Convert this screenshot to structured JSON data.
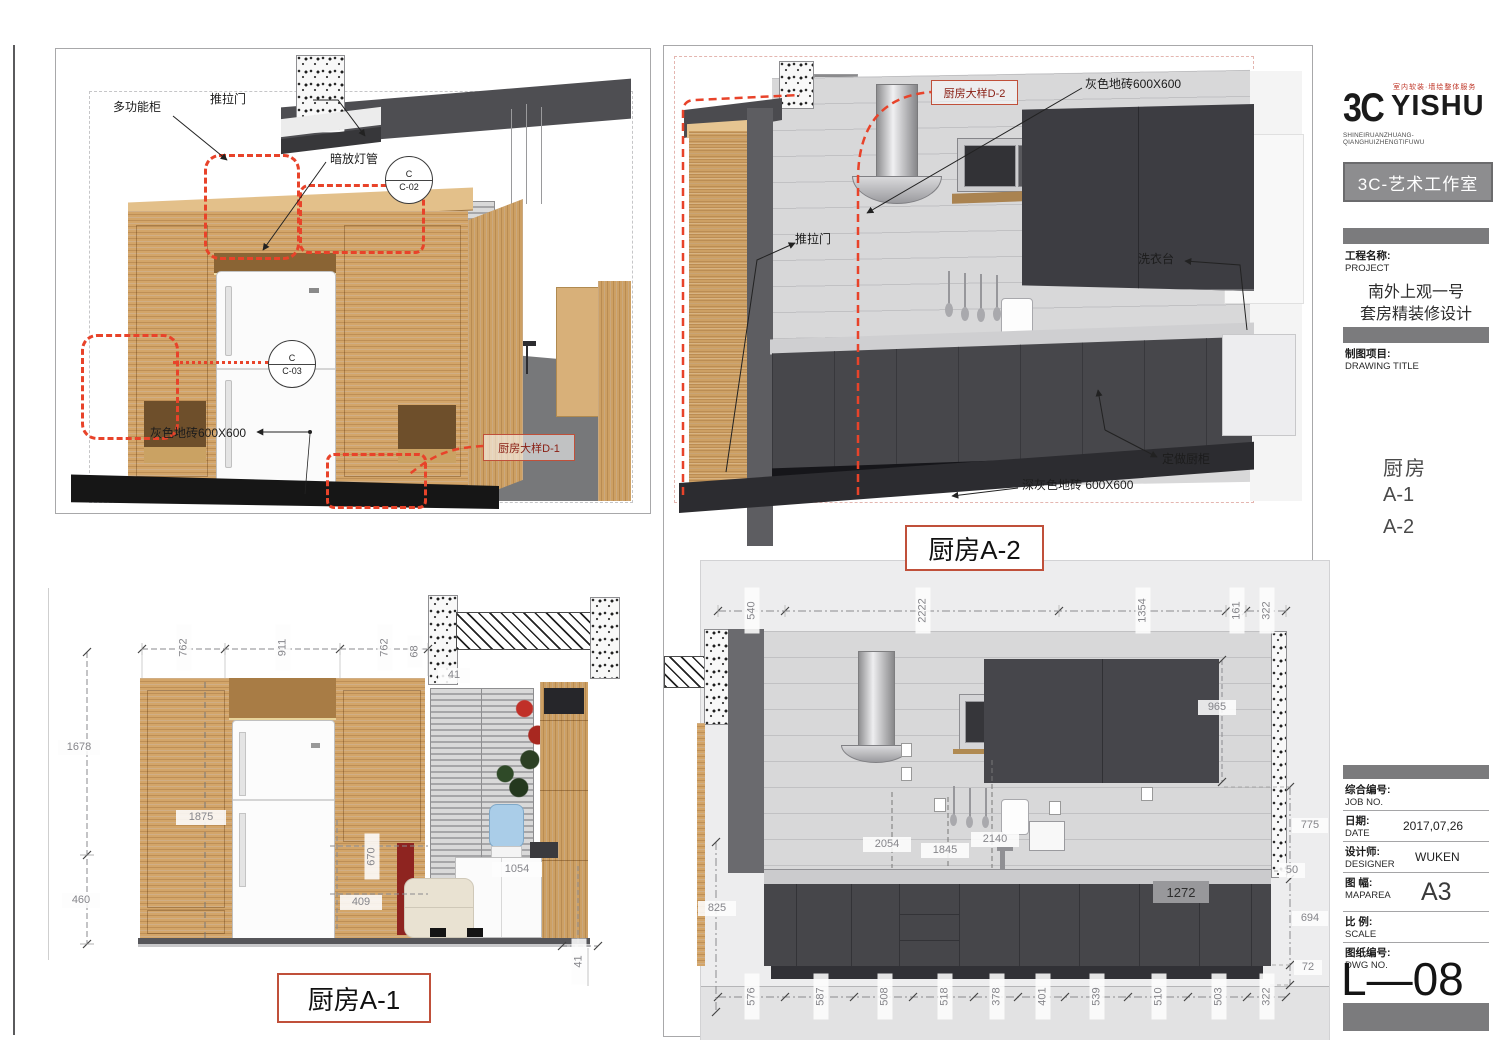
{
  "logo": {
    "mark": "3C",
    "name": "YISHU",
    "tagline_cn": "室内软装·墙绘整体服务",
    "tagline_en": "SHINEIRUANZHUANG-QIANGHUIZHENGTIFUWU",
    "studio_box": "3C-艺术工作室"
  },
  "titleblock": {
    "project": {
      "label_cn": "工程名称:",
      "label_en": "PROJECT",
      "line1": "南外上观一号",
      "line2": "套房精装修设计"
    },
    "drawing_title": {
      "label_cn": "制图项目:",
      "label_en": "DRAWING TITLE"
    },
    "drawing_name": {
      "line1": "厨房",
      "line2": "A-1",
      "line3": "A-2"
    },
    "job": {
      "label_cn": "综合编号:",
      "label_en": "JOB NO."
    },
    "date": {
      "label_cn": "日期:",
      "label_en": "DATE",
      "value": "2017,07,26"
    },
    "designer": {
      "label_cn": "设计师:",
      "label_en": "DESIGNER",
      "value": "WUKEN"
    },
    "map": {
      "label_cn": "图 幅:",
      "label_en": "MAPAREA",
      "value": "A3"
    },
    "scale": {
      "label_cn": "比 例:",
      "label_en": "SCALE"
    },
    "dwg": {
      "label_cn": "图纸编号:",
      "label_en": "DWG NO.",
      "value": "L—08"
    }
  },
  "view_a1": {
    "title": "厨房A-1",
    "labels": {
      "multi_cabinet": "多功能柜",
      "sliding_door": "推拉门",
      "hidden_light": "暗放灯管",
      "floor_tile": "灰色地砖600X600",
      "detail_ref": "厨房大样D-1",
      "callout_c2_top": "C",
      "callout_c2_bottom": "C-02",
      "callout_c3_top": "C",
      "callout_c3_bottom": "C-03"
    },
    "dims": {
      "top": [
        "762",
        "911",
        "762"
      ],
      "beam": "68",
      "beam2": "41",
      "left_upper": "1678",
      "left_lower": "460",
      "cabinet": "1875",
      "right_a": "670",
      "right_b": "409",
      "right_c": "1054",
      "bottom": "41"
    }
  },
  "view_a2": {
    "title": "厨房A-2",
    "labels": {
      "detail_ref": "厨房大样D-2",
      "wall_tile": "灰色地砖600X600",
      "sliding_door": "推拉门",
      "laundry": "洗衣台",
      "custom_cabinet": "定做厨柜",
      "floor_tile": "深灰色地砖 600X600"
    },
    "dims": {
      "top": [
        "540",
        "2222",
        "1354",
        "161",
        "322"
      ],
      "bottom": [
        "576",
        "587",
        "508",
        "518",
        "378",
        "401",
        "539",
        "510",
        "503",
        "322"
      ],
      "left": "825",
      "cabinet_height": "965",
      "right": [
        "775",
        "50",
        "694",
        "72"
      ],
      "mid": [
        "2054",
        "1845",
        "2140"
      ],
      "base_width": "1272"
    }
  }
}
